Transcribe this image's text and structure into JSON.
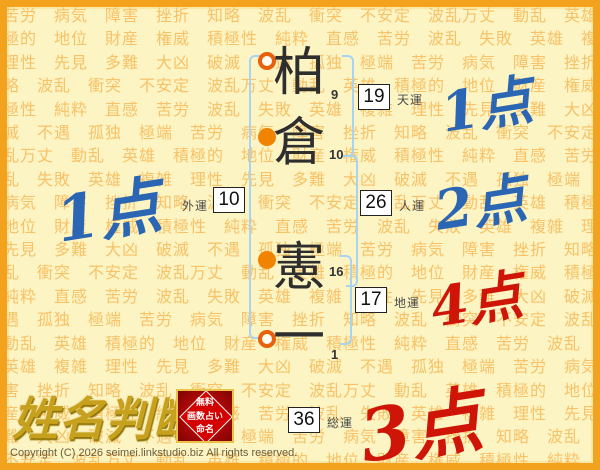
{
  "background": {
    "words": [
      "苦労",
      "病気",
      "障害",
      "挫折",
      "知略",
      "波乱",
      "衝突",
      "不安定",
      "波乱万丈",
      "動乱",
      "英雄",
      "積極的",
      "地位",
      "財産",
      "権威",
      "積極性",
      "純粋",
      "直感",
      "苦労",
      "波乱",
      "失敗",
      "英雄",
      "複雑",
      "理性",
      "先見",
      "多難",
      "大凶",
      "破滅",
      "不遇",
      "孤独",
      "極端"
    ],
    "repeat": 16
  },
  "name": {
    "characters": [
      {
        "char": "柏",
        "strokes": "9",
        "marker": "open"
      },
      {
        "char": "倉",
        "strokes": "10",
        "marker": "filled"
      },
      {
        "char": "憲",
        "strokes": "16",
        "marker": "filled"
      },
      {
        "char": "一",
        "strokes": "1",
        "marker": "open"
      }
    ]
  },
  "fortunes": {
    "tenun": {
      "label": "天運",
      "value": "19",
      "score": "1点"
    },
    "jinun": {
      "label": "人運",
      "value": "26",
      "score": "2点"
    },
    "chiun": {
      "label": "地運",
      "value": "17",
      "score": "4点"
    },
    "gaiun": {
      "label": "外運",
      "value": "10",
      "score": "1点"
    },
    "soun": {
      "label": "総運",
      "value": "36",
      "score": "3点"
    }
  },
  "colors": {
    "score_blue": "#2A66B4",
    "score_red": "#CE1508",
    "marker_orange": "#F08300",
    "bracket_blue": "#A7D4F2",
    "background_words": "#F7C268",
    "frame_border": "#F2A21D"
  },
  "logo": {
    "title": "姓名判断",
    "stamp_lines": [
      "無料",
      "画数占い",
      "命名"
    ]
  },
  "footer": {
    "copyright": "Copyright (C) 2026 seimei.linkstudio.biz All rights reserved."
  }
}
